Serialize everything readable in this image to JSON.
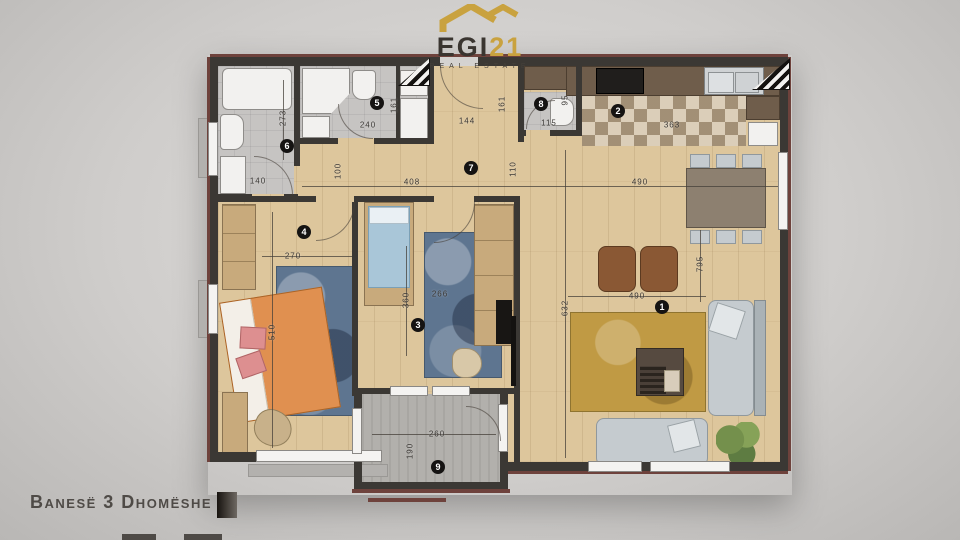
{
  "logo": {
    "brand": "EGI",
    "brand_suffix": "21",
    "tagline": "REAL ESTATE"
  },
  "caption": "Banesë 3 Dhomëshe",
  "plan": {
    "markers": [
      "1",
      "2",
      "3",
      "4",
      "5",
      "6",
      "7",
      "8",
      "9"
    ],
    "marker_rooms": [
      "living-room",
      "kitchen",
      "bedroom",
      "bedroom",
      "bathroom",
      "bathroom",
      "hallway",
      "wc",
      "balcony"
    ],
    "dims": [
      "273",
      "140",
      "240",
      "161",
      "144",
      "161",
      "115",
      "95",
      "363",
      "408",
      "100",
      "110",
      "490",
      "270",
      "510",
      "360",
      "266",
      "632",
      "490",
      "795",
      "260",
      "190"
    ],
    "colors": {
      "wall": "#3b3834",
      "trim": "#6e423c",
      "wood_floor": "#ddc69c",
      "accent_gold": "#c9a23f"
    }
  }
}
